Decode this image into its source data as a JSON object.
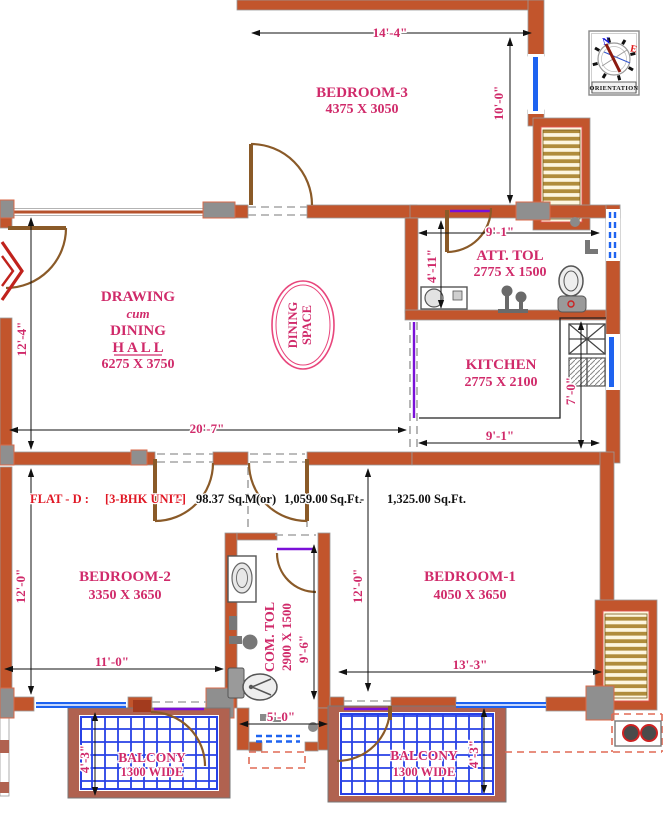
{
  "rooms": {
    "bedroom3": {
      "name": "BEDROOM-3",
      "size": "4375 X 3050"
    },
    "hall": {
      "line1": "DRAWING",
      "line2": "cum",
      "line3": "DINING",
      "line4": "H A L L",
      "size": "6275 X 3750"
    },
    "dining_space": {
      "line1": "DINING",
      "line2": "SPACE"
    },
    "att_tol": {
      "name": "ATT. TOL",
      "size": "2775 X 1500"
    },
    "kitchen": {
      "name": "KITCHEN",
      "size": "2775 X 2100"
    },
    "bedroom2": {
      "name": "BEDROOM-2",
      "size": "3350 X 3650"
    },
    "com_tol": {
      "name": "COM. TOL",
      "size": "2900 X 1500"
    },
    "bedroom1": {
      "name": "BEDROOM-1",
      "size": "4050 X 3650"
    },
    "balcony_left": {
      "name": "BALCONY",
      "size": "1300 WIDE"
    },
    "balcony_right": {
      "name": "BALCONY",
      "size": "1300 WIDE"
    }
  },
  "dims": {
    "top_width": "14'-4\"",
    "right_height": "10'-0\"",
    "att_tol_width": "9'-1\"",
    "att_tol_height": "4'-11\"",
    "hall_height": "12'-4\"",
    "hall_width": "20'-7\"",
    "kitchen_height": "7'-0\"",
    "kitchen_width": "9'-1\"",
    "bedroom2_height": "12'-0\"",
    "bedroom2_width": "11'-0\"",
    "com_tol_height": "9'-6\"",
    "com_tol_exit_width": "5'-0\"",
    "bedroom1_height": "12'-0\"",
    "bedroom1_width": "13'-3\"",
    "balcony_left_depth": "4'-3\"",
    "balcony_right_depth": "4'-3\""
  },
  "flat_band": {
    "flat_label": "FLAT - D :",
    "unit_label": "[3-BHK UNIT]",
    "sep1": "-",
    "area_sqm": "98.37",
    "unit_sqm": "Sq.M.",
    "or_label": "(or)",
    "area_sqft": "1,059.00",
    "unit_sqft": "Sq.Ft.",
    "sep2": "-",
    "total_sqft": "1,325.00",
    "unit_sqft2": "Sq.Ft."
  },
  "compass": {
    "north": "N",
    "east": "E",
    "label": "ORIENTATION"
  },
  "colors": {
    "wall": "#c2552c",
    "label_pink": "#d02a6a",
    "flat_red": "#e01825",
    "window_blue": "#1e63f0",
    "door_brown": "#8a5a28",
    "grid_blue": "#2741e6",
    "stair_tan": "#b08c3c",
    "dashed_red": "#e06a55",
    "vent_purple": "#7a10d8",
    "column_gray": "#8f8f8f",
    "balcony_frame": "#b06250"
  }
}
